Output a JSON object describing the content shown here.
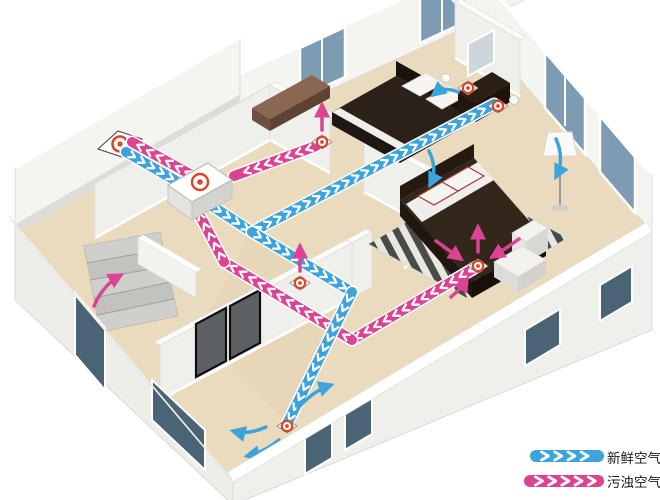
{
  "legend": {
    "items": [
      {
        "id": "fresh-air",
        "label": "新鲜空气",
        "swatch_icon": "blue-chevron-flow-band"
      },
      {
        "id": "exhaust-air",
        "label": "污浊空气",
        "swatch_icon": "pink-chevron-flow-band"
      }
    ]
  },
  "colors": {
    "fresh_air": "#3da3dc",
    "exhaust_air": "#dc4392",
    "vent_ring": "#d9482b",
    "floor": "#eadbbe",
    "wall_face": "#f4f4f1",
    "wall_shade": "#e9e9e5",
    "glass": "#7d9cb4",
    "glass_dark": "#4a6375",
    "bed_dark": "#2c2118",
    "wood_brown": "#8a6752",
    "background": "#ffffff",
    "legend_text": "#1a1a1a"
  },
  "icons": {
    "air_vent": "concentric-red-ring-diffuser",
    "exterior_wall_vent": "wall-diamond-red-ring",
    "ventilation_unit": "white-box-red-ring-grille",
    "fresh_air_flow": "blue-chevron-duct-band",
    "exhaust_air_flow": "pink-chevron-duct-band",
    "room_airflow": "curved-arrow"
  },
  "diagram": {
    "scene": "isometric-house-cutaway-fresh-air-ventilation"
  }
}
